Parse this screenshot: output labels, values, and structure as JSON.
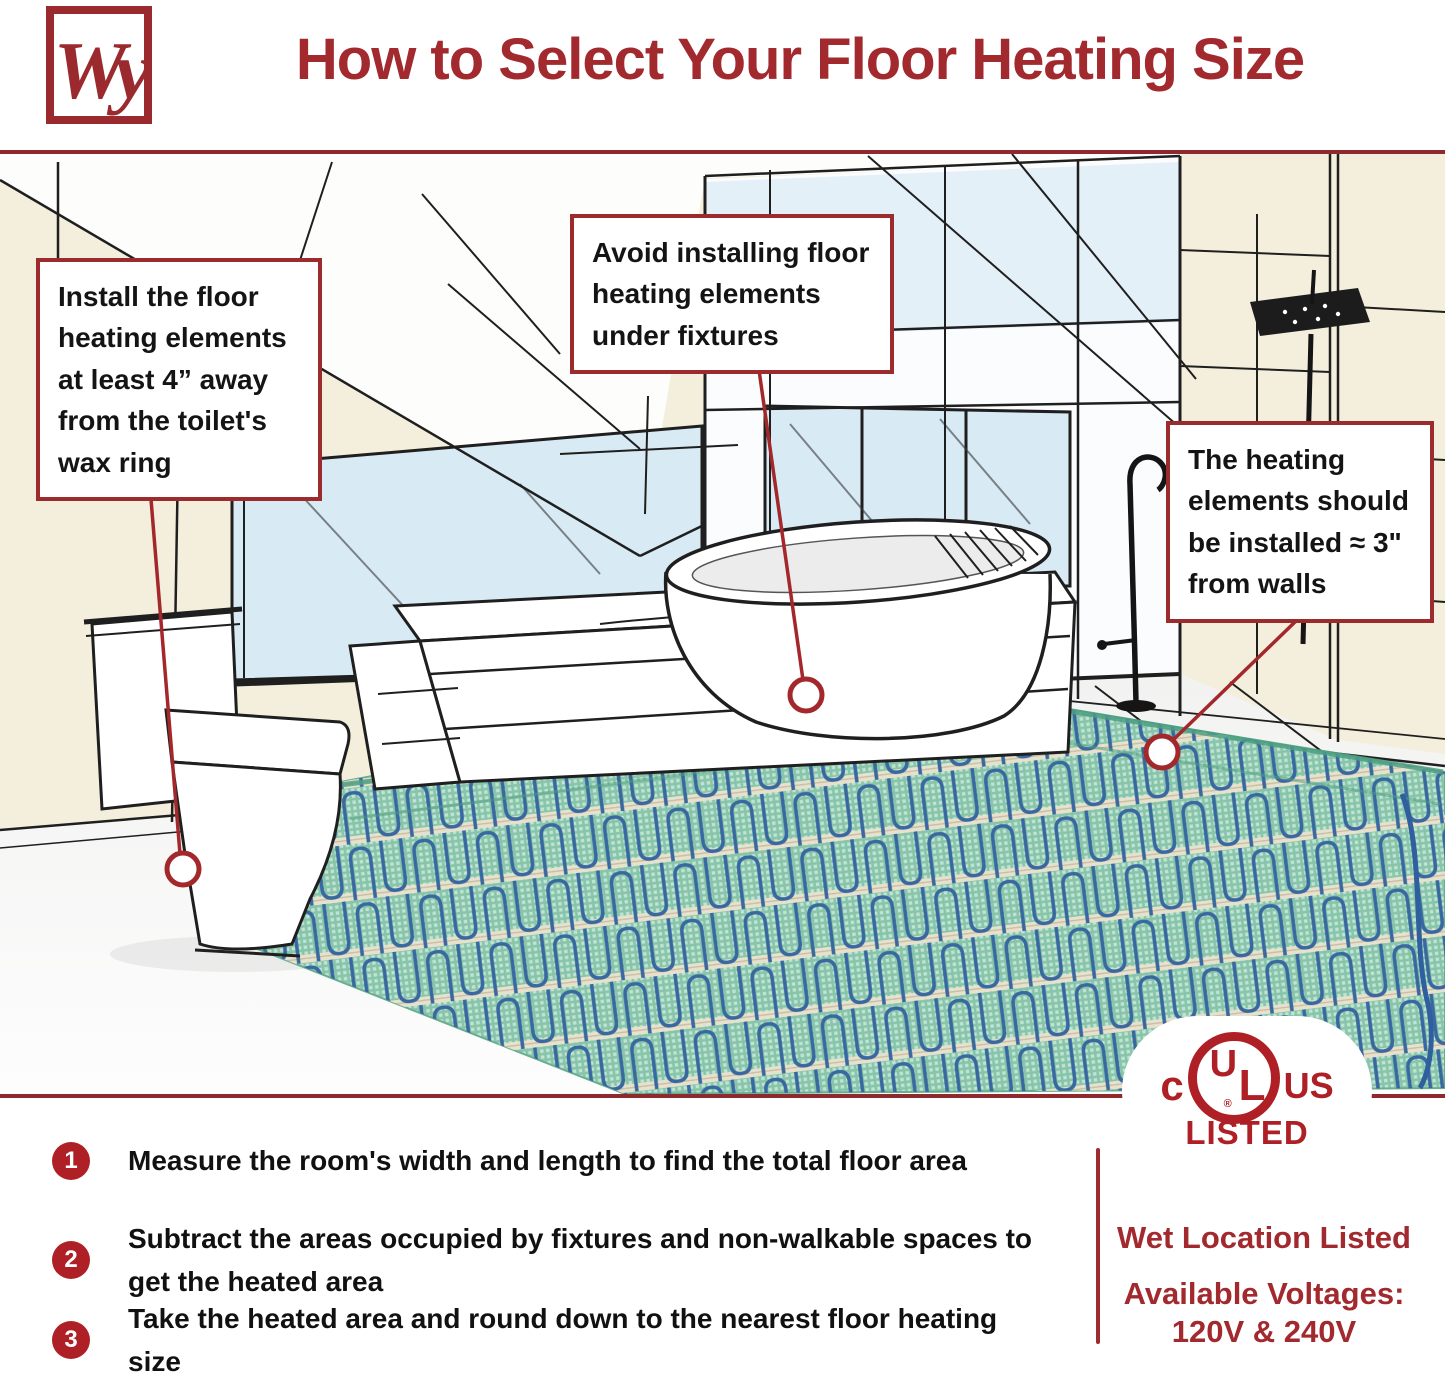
{
  "header": {
    "logo_text": "Wy",
    "title": "How to Select Your Floor Heating Size"
  },
  "callouts": {
    "toilet": "Install the floor heating elements at least 4” away from the toilet's wax ring",
    "fixtures": "Avoid installing floor heating elements under fixtures",
    "walls": "The heating elements should be installed ≈ 3\" from walls"
  },
  "steps": [
    {
      "number": "1",
      "text": "Measure the room's width and length to find the total floor area"
    },
    {
      "number": "2",
      "text": "Subtract the areas occupied by fixtures and non-walkable spaces to get the heated area"
    },
    {
      "number": "3",
      "text": "Take the heated area and round down to the nearest floor heating size"
    }
  ],
  "certification": {
    "ul_prefix": "c",
    "ul_u": "U",
    "ul_l": "L",
    "ul_suffix": "US",
    "registered": "®",
    "listed": "LISTED",
    "wet_location": "Wet Location Listed",
    "voltages_label": "Available Voltages:",
    "voltages_value": "120V & 240V"
  },
  "colors": {
    "brand_red": "#A2292E",
    "badge_red": "#AE2025",
    "callout_border_red": "#9C2B2E",
    "rule_red": "#8E2A2D",
    "wall_cream": "#F4EFDC",
    "window_blue": "#D8EAF4",
    "mat_green": "#87C5AA",
    "cable_blue": "#33639E",
    "tape_tan": "#EAE2CF"
  }
}
